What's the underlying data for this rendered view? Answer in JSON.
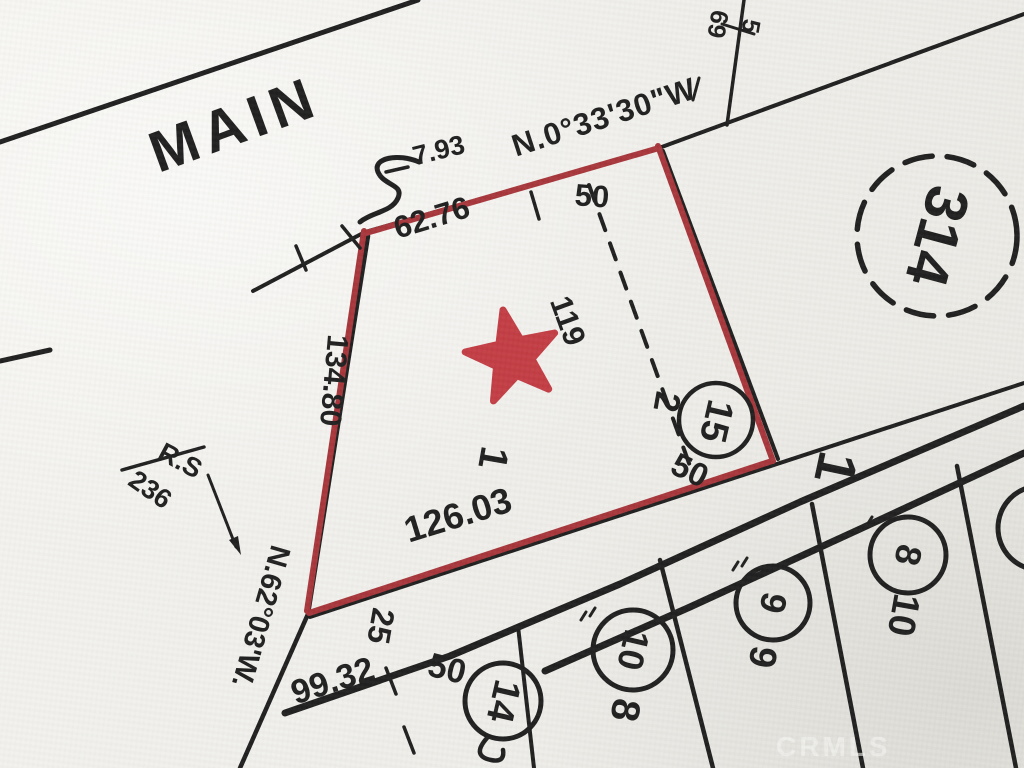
{
  "colors": {
    "paper": "#f0efeb",
    "ink": "#1c1c1c",
    "red": "#a63338",
    "star": "#c23a41",
    "watermark": "#f7f7f4"
  },
  "street": {
    "name": "MAIN"
  },
  "bearings": {
    "main_frontage": "N.0°33'30\"W",
    "west_line": "N.62°03'W."
  },
  "dimensions": {
    "offset_793": "7.93",
    "north_6276": "62.76",
    "north_50": "50",
    "east_dashed_119": "119",
    "south_12603": "126.03",
    "west_13480": "134.80",
    "southeast_50": "50",
    "strip_25": "25",
    "lower_9932": "99.32",
    "lower_50": "50"
  },
  "reference": {
    "rs_top": "R.S",
    "rs_bottom": "236"
  },
  "lots": {
    "parcel_1": "1",
    "adjacent_2": "2",
    "circle_15": "15",
    "circle_14": "14",
    "circle_10": "10",
    "circle_9": "9",
    "circle_8": "8",
    "below_circle_10": "8",
    "below_circle_9": "9",
    "below_circle_8": "10",
    "block_bold_1": "1",
    "page_circle_314": "314",
    "upper_69": "69",
    "upper_5": "5"
  },
  "watermark": {
    "text": "CRMLS"
  }
}
